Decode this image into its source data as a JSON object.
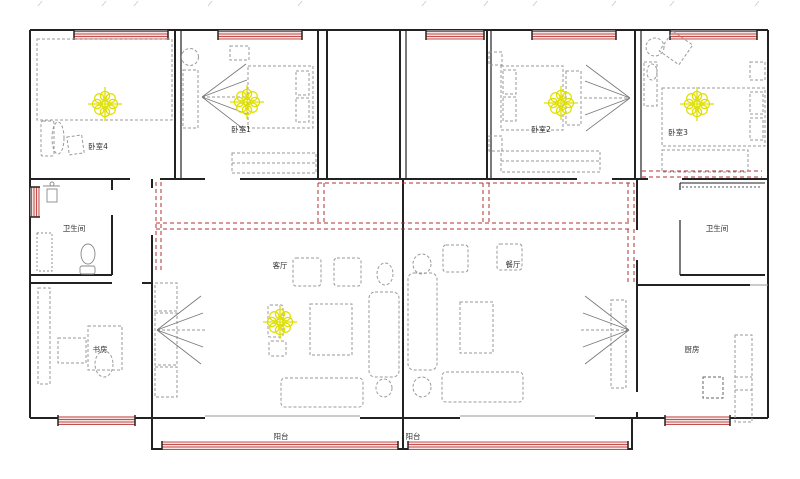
{
  "canvas": {
    "width": 800,
    "height": 479,
    "background": "#ffffff"
  },
  "colors": {
    "wall": "#222222",
    "furniture": "#9a9a9a",
    "window_stroke": "#c4504e",
    "window_fill": "#f6e2e1",
    "wiring": "#b03030",
    "ceiling_light": "#e0e000",
    "label": "#333333"
  },
  "rooms": [
    {
      "id": "bedroom-4",
      "label": "卧室4"
    },
    {
      "id": "bedroom-1",
      "label": "卧室1"
    },
    {
      "id": "bedroom-2",
      "label": "卧室2"
    },
    {
      "id": "bedroom-3",
      "label": "卧室3"
    },
    {
      "id": "bathroom-left",
      "label": "卫生间"
    },
    {
      "id": "living-room",
      "label": "客厅"
    },
    {
      "id": "dining-room",
      "label": "餐厅"
    },
    {
      "id": "bathroom-right",
      "label": "卫生间"
    },
    {
      "id": "study",
      "label": "书房"
    },
    {
      "id": "kitchen",
      "label": "厨房"
    },
    {
      "id": "balcony-left",
      "label": "阳台"
    },
    {
      "id": "balcony-right",
      "label": "阳台"
    }
  ],
  "fixtures": {
    "ceiling_light_symbol": "flower-of-circles-with-cross",
    "ceiling_light_count": 5,
    "ceiling_light_rooms": [
      "卧室4",
      "卧室1",
      "卧室2",
      "卧室3",
      "客厅"
    ],
    "window_symbol": "red-hatched-band",
    "wiring_symbol": "red-dashed-line"
  }
}
